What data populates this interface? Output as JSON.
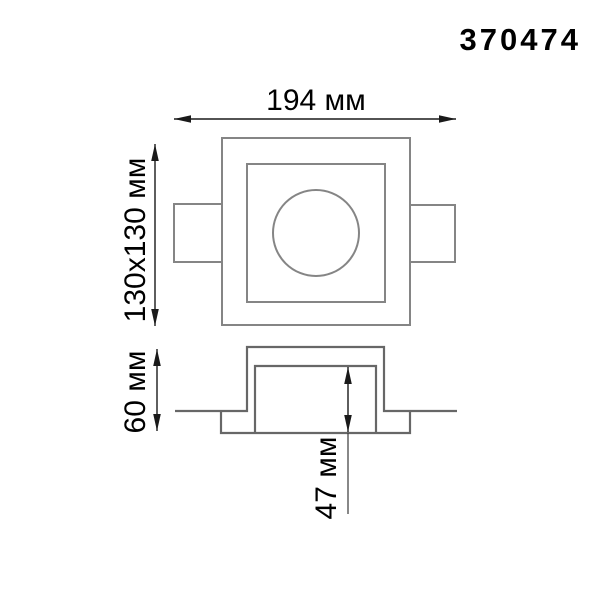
{
  "product": {
    "code": "370474"
  },
  "dimensions": {
    "overall_width": "194 мм",
    "face_size": "130x130 мм",
    "overall_height": "60 мм",
    "recess_depth": "47 мм"
  },
  "units": "мм",
  "views": {
    "top_view": "front/top view of square recessed fixture with lamp opening and two side mounting tabs",
    "section_view": "side section profile of recessed housing with ceiling flange"
  },
  "colors": {
    "background": "#ffffff",
    "outline_gray": "#858585",
    "section_gray": "#676767",
    "dimension_black": "#1a1a1a",
    "text_black": "#000000"
  }
}
